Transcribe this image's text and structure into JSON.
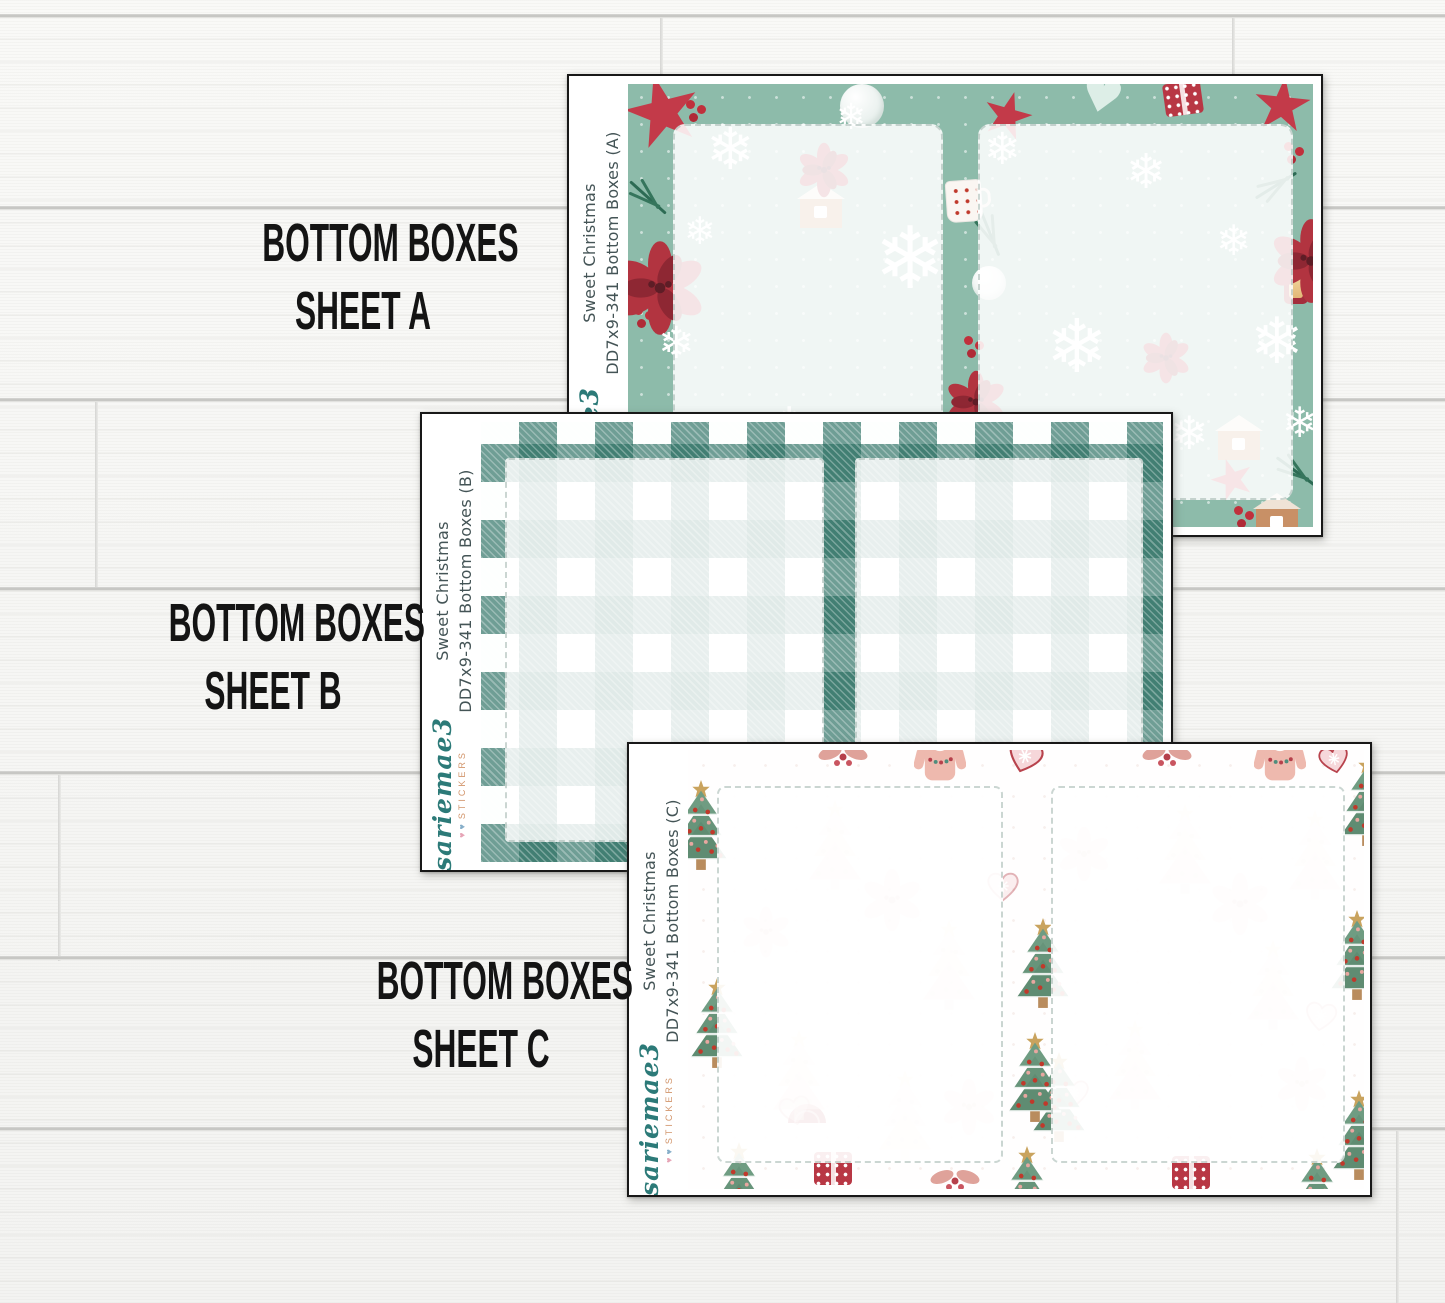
{
  "product_labels": [
    {
      "line1": "BOTTOM BOXES",
      "line2": "SHEET A"
    },
    {
      "line1": "BOTTOM BOXES",
      "line2": "SHEET B"
    },
    {
      "line1": "BOTTOM BOXES",
      "line2": "SHEET C"
    }
  ],
  "sheets": [
    {
      "letter": "A",
      "collection": "Sweet Christmas",
      "sku_line": "DD7x9-341 Bottom Boxes (A)"
    },
    {
      "letter": "B",
      "collection": "Sweet Christmas",
      "sku_line": "DD7x9-341 Bottom Boxes (B)"
    },
    {
      "letter": "C",
      "collection": "Sweet Christmas",
      "sku_line": "DD7x9-341 Bottom Boxes (C)"
    }
  ],
  "brand": {
    "name": "sariemae3",
    "tagline": "STICKERS",
    "heart1": "♥",
    "heart2": "♥"
  },
  "colors": {
    "sheet_a_green": "#8dbbaa",
    "holiday_red": "#c23b49",
    "plaid_teal": "#2f7466",
    "logo_teal": "#2c7a78",
    "logo_orange": "#d2956b",
    "caption_black": "#141414",
    "side_text_gray": "#445456",
    "wood_white": "#f7f7f5"
  }
}
